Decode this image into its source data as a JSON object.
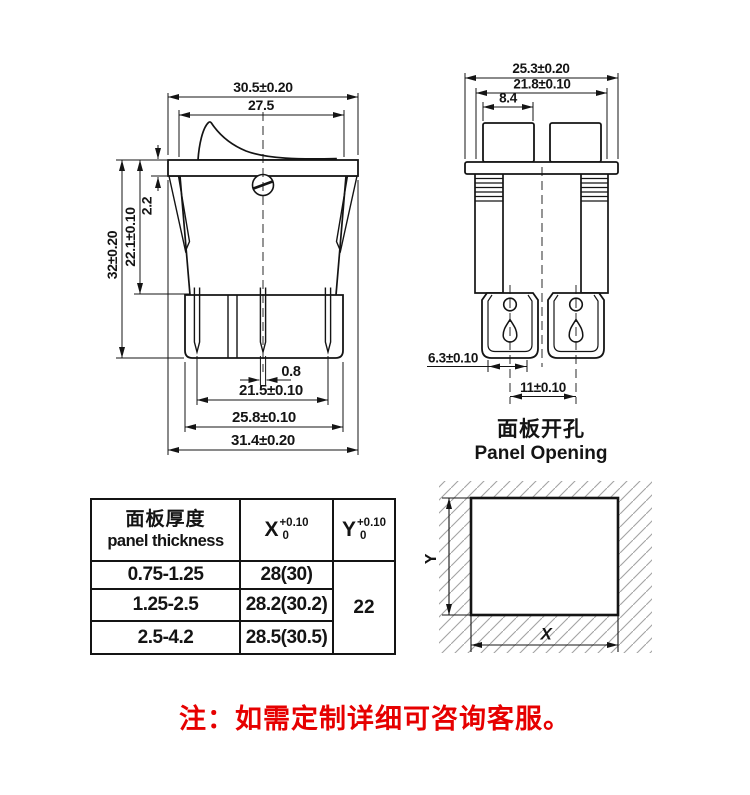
{
  "front_view": {
    "dims": {
      "top_width": "30.5±0.20",
      "rocker_width": "27.5",
      "flange_thickness": "2.2",
      "body_depth": "22.1±0.10",
      "total_depth": "32±0.20",
      "pin_thickness": "0.8",
      "pin_spacing": "21.5±0.10",
      "base_width": "25.8±0.10",
      "overall_width": "31.4±0.20"
    }
  },
  "side_view": {
    "dims": {
      "top_width": "25.3±0.20",
      "inner_width": "21.8±0.10",
      "button_width": "8.4",
      "terminal_width": "6.3±0.10",
      "terminal_spacing": "11±0.10"
    },
    "caption_cn": "面板开孔",
    "caption_en": "Panel Opening"
  },
  "panel_opening": {
    "x_label": "X",
    "y_label": "Y"
  },
  "spec_table": {
    "header": {
      "thickness_cn": "面板厚度",
      "thickness_en": "panel thickness",
      "x_base": "X",
      "x_sup": "+0.10",
      "x_sub": "0",
      "y_base": "Y",
      "y_sup": "+0.10",
      "y_sub": "0"
    },
    "rows": [
      {
        "thickness": "0.75-1.25",
        "x": "28(30)"
      },
      {
        "thickness": "1.25-2.5",
        "x": "28.2(30.2)"
      },
      {
        "thickness": "2.5-4.2",
        "x": "28.5(30.5)"
      }
    ],
    "y_value": "22"
  },
  "note": {
    "text": "注：如需定制详细可咨询客服。"
  },
  "colors": {
    "line": "#141414",
    "note_red": "#e60000",
    "hatch": "#a3a3a3"
  }
}
